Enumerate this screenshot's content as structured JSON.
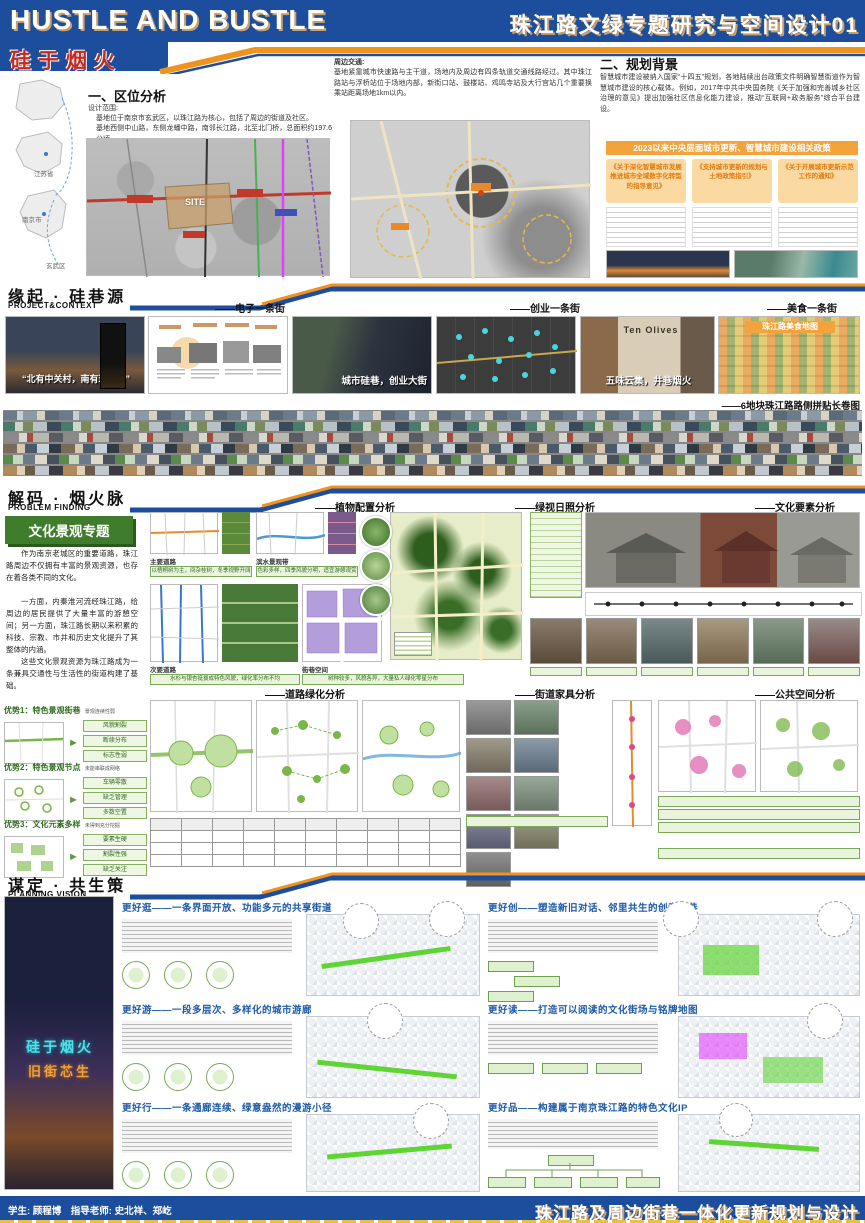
{
  "header": {
    "title_en": "HUSTLE AND BUSTLE",
    "title_cn": "珠江路文绿专题研究与空间设计01",
    "slogan": "硅于烟火"
  },
  "region_maps": {
    "labels": [
      "江苏省",
      "南京市",
      "玄武区"
    ]
  },
  "location": {
    "heading": "一、区位分析",
    "scope_label": "设计范围:",
    "scope_line1": "基地位于南京市玄武区，以珠江路为核心，包括了周边的街道及社区。",
    "scope_line2": "基地西侧中山路，东侧龙蟠中路，南邻长江路，北至北门桥，总面积约197.6公顷。",
    "site_label": "SITE"
  },
  "traffic": {
    "label": "周边交通:",
    "text": "基地紧靠城市快速路与主干道，场地内及周边有四条轨道交通线路经过。其中珠江路站与浮桥站位于场地内部，新街口站、鼓楼站、鸡鸣寺站及大行宫站几个重要换乘站距离场地1km以内。"
  },
  "background": {
    "heading": "二、规划背景",
    "text": "智慧城市建设被纳入国家“十四五”规划，各地陆续出台政策文件明确智慧街道作为智慧城市建设的核心载体。例如，2017年中共中央国务院《关于加强和完善城乡社区治理的意见》提出加强社区信息化能力建设，推动“互联网+政务服务”综合平台建设。",
    "banner": "2023以来中央层面城市更新、智慧城市建设相关政策",
    "policies": [
      "《关于深化智慧城市发展 推进城市全域数字化转型的指导意见》",
      "《支持城市更新的规划与土地政策指引》",
      "《关于开展城市更新示范工作的通知》"
    ]
  },
  "section2": {
    "title_cn": "缘起 · 硅巷源",
    "title_en": "PROJECT&CONTEXT",
    "subheads": [
      "——电子一条街",
      "——创业一条街",
      "——美食一条街"
    ],
    "quote1": "“北有中关村，南有珠江路”",
    "caption1": "城市硅巷，创业大街",
    "shop_sign": "Ten Olives",
    "quote2": "五味云集，井巷烟火",
    "foodmap_title": "珠江路美食地图",
    "strip_caption": "——6地块珠江路路侧拼贴长卷图"
  },
  "section3": {
    "title_cn": "解码 · 烟火脉",
    "title_en": "PROBLEM FINDING",
    "heads_top": [
      "——植物配置分析",
      "——绿视日照分析",
      "——文化要素分析"
    ],
    "heads_mid": [
      "——道路绿化分析",
      "——街道家具分析",
      "——公共空间分析"
    ],
    "culture_topic": {
      "title": "文化景观专题",
      "p1": "作为南京老城区的重要道路，珠江路周边不仅拥有丰富的景观资源，也存在着各类不同的文化。",
      "p2": "一方面，内秦淮河流经珠江路，给周边的居民提供了大量丰富的游憩空间；另一方面，珠江路长期以来积累的科技、宗教、市井和历史文化提升了其整体的内涵。",
      "p3": "这些文化景观资源为珠江路成为一条兼具交通性与生活性的街道构建了基础。"
    },
    "plant_panels": [
      {
        "label": "主要道路",
        "caption": "以梧桐树为主，间杂桂树，冬季视野开阔"
      },
      {
        "label": "滨水景观带",
        "caption": "色彩多样，四季风貌分明，适宜游憩观赏"
      },
      {
        "label": "次要道路",
        "caption": "水杉与银杏挺拔成特色风貌，绿化率分布不均"
      },
      {
        "label": "街巷空间",
        "caption": "树种较多，风貌各异，大量私人绿化零星分布"
      }
    ],
    "advantages": [
      {
        "label": "优势1：特色景观街巷",
        "note": "景观连续性弱",
        "boxes": [
          "风貌割裂",
          "断续分布",
          "标志性弱"
        ]
      },
      {
        "label": "优势2：特色景观节点",
        "note": "未能串联成网络",
        "boxes": [
          "车辆零散",
          "缺乏管理",
          "多数空置"
        ]
      },
      {
        "label": "优势3：文化元素多样",
        "note": "未得到充分挖掘",
        "boxes": [
          "要素生硬",
          "割裂性强",
          "缺乏关注"
        ]
      }
    ]
  },
  "section4": {
    "title_cn": "谋定 · 共生策",
    "title_en": "PLANNING VISION",
    "neon_text1": "硅于烟火",
    "neon_text2": "旧街芯生",
    "visions": [
      {
        "title": "更好逛——一条界面开放、功能多元的共享街道"
      },
      {
        "title": "更好游——一段多层次、多样化的城市游廊"
      },
      {
        "title": "更好行——一条通廊连续、绿意盎然的漫游小径"
      },
      {
        "title": "更好创——塑造新旧对话、邻里共生的创意坊巷"
      },
      {
        "title": "更好读——打造可以阅读的文化街场与铭牌地图"
      },
      {
        "title": "更好品——构建属于南京珠江路的特色文化IP"
      }
    ]
  },
  "footer": {
    "credits": "学生: 顾程博　指导老师: 史北祥、郑屹",
    "project_title": "珠江路及周边街巷一体化更新规划与设计"
  },
  "colors": {
    "header_blue": "#1d4e9e",
    "accent_orange": "#f0921e",
    "tan_shadow": "#c9a06b",
    "slogan_red": "#c8281e",
    "theme_green": "#3f7d2c"
  }
}
